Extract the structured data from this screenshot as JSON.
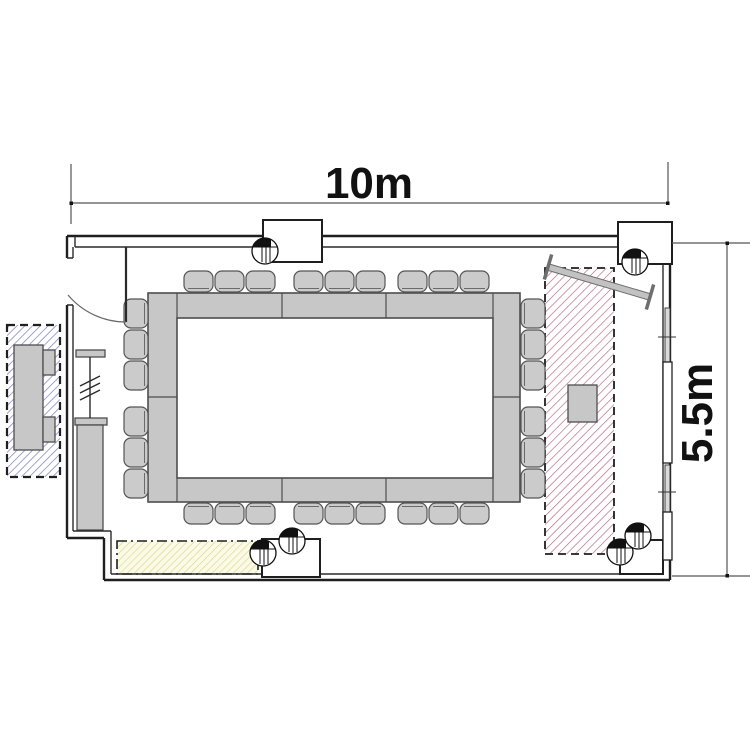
{
  "title": "meeting-room-floor-plan",
  "dimensions": {
    "width_label": "10m",
    "height_label": "5.5m"
  },
  "colors": {
    "wall": "#1f1f1f",
    "inner_wall": "#2a2a2a",
    "furniture_fill": "#c7c7c7",
    "furniture_stroke": "#4d4d4d",
    "chair_fill": "#cbcbcb",
    "chair_stroke": "#555555",
    "hatch_red": "#b2677e",
    "hatch_yellow": "#d6d689",
    "yellow_bg": "#fafae6",
    "hatch_blue": "#8383bd",
    "screen_fill": "#c2c2c2",
    "screen_cap": "#6e6e6e",
    "window_pane": "#ffffff",
    "mullion_fill": "#d9d9d9",
    "dim_line": "#555555",
    "text": "#111111"
  },
  "floorplan": {
    "zones": [
      {
        "name": "hatched-zone-red",
        "x": 545,
        "y": 268,
        "w": 69,
        "h": 286,
        "pattern": "red",
        "dash": "8,5",
        "sw": 1.8
      },
      {
        "name": "hatched-zone-yellow",
        "x": 117,
        "y": 541,
        "w": 141,
        "h": 33,
        "pattern": "yellow",
        "dash": "10,4,2,4",
        "sw": 1.6
      },
      {
        "name": "hatched-zone-blue",
        "x": 7,
        "y": 325,
        "w": 53,
        "h": 152,
        "pattern": "blue",
        "dash": "8,5",
        "sw": 2.2
      }
    ],
    "table": {
      "outer": [
        148,
        293,
        372,
        209
      ],
      "inner": [
        177,
        318,
        316,
        160
      ],
      "top_dividers_x": [
        282,
        386
      ],
      "band_seams_x": [
        177,
        493
      ],
      "side_divider_y": 397
    },
    "chairs": {
      "w": 29,
      "h": 21,
      "top_y": 271,
      "bottom_y": 503,
      "row_xs": [
        184,
        215,
        246,
        294,
        325,
        356,
        398,
        429,
        460
      ],
      "side_w": 24,
      "side_h": 29,
      "left_x": 124,
      "right_x": 521,
      "side_ys": [
        299,
        330,
        361,
        407,
        438,
        469
      ]
    },
    "columns": {
      "r": 13,
      "centers": [
        [
          265,
          251
        ],
        [
          635,
          262
        ],
        [
          263,
          553
        ],
        [
          292,
          541
        ],
        [
          620,
          552
        ],
        [
          638,
          536
        ]
      ]
    },
    "niches": [
      [
        263,
        220,
        59,
        42
      ],
      [
        618,
        222,
        54,
        42
      ],
      [
        262,
        539,
        58,
        38
      ],
      [
        620,
        540,
        43,
        34
      ]
    ],
    "windows": {
      "mullions": [
        [
          665,
          308,
          5,
          54
        ],
        [
          665,
          465,
          5,
          47
        ]
      ],
      "panes": [
        [
          663,
          362,
          9,
          101
        ],
        [
          663,
          512,
          9,
          48
        ]
      ],
      "ticks_y": [
        337,
        492
      ]
    },
    "fixtures": [
      {
        "name": "cabinet-body",
        "x": 14,
        "y": 345,
        "w": 29,
        "h": 105
      },
      {
        "name": "cabinet-knob",
        "x": 43,
        "y": 350,
        "w": 12,
        "h": 25
      },
      {
        "name": "cabinet-knob",
        "x": 43,
        "y": 417,
        "w": 12,
        "h": 25
      },
      {
        "name": "partition-rail-top",
        "x": 76,
        "y": 350,
        "w": 29,
        "h": 7
      },
      {
        "name": "partition-rail-bottom",
        "x": 75,
        "y": 418,
        "w": 32,
        "h": 7
      },
      {
        "name": "wall-pillar",
        "x": 77,
        "y": 425,
        "w": 26,
        "h": 105
      },
      {
        "name": "lectern",
        "x": 568,
        "y": 385,
        "w": 29,
        "h": 37
      }
    ],
    "screen": {
      "x1": 548,
      "y1": 267,
      "x2": 650,
      "y2": 297,
      "cap_len": 26
    }
  }
}
